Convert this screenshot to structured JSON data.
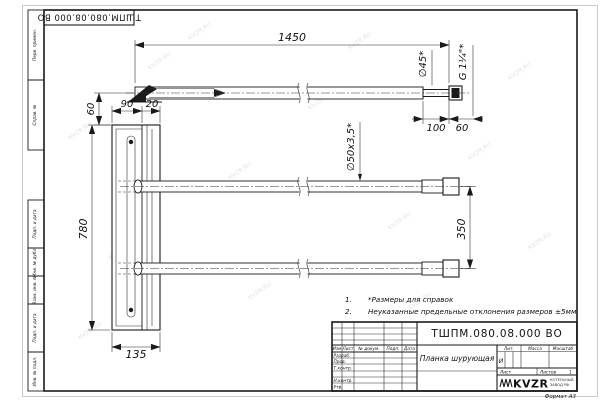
{
  "watermark": {
    "text": "KVZR.RU"
  },
  "doc_number": "ТШПМ.080.08.000 ВО",
  "side_labels": [
    "Перв. примен.",
    "Справ. №",
    "Подп. и дата",
    "Инв. № дубл.",
    "Взам. инв. №",
    "Подп. и дата",
    "Инв. № подл."
  ],
  "dims": {
    "overall_length": "1450",
    "top_offset": "60",
    "plate_width": "90",
    "plate_lip": "20",
    "plate_height": "780",
    "plate_base": "135",
    "tube_gap": "350",
    "neck_length": "100",
    "thread_length": "60"
  },
  "labels": {
    "dia_tube": "∅50x3,5*",
    "dia_end": "∅45*",
    "thread": "G 1¼\"*"
  },
  "notes": [
    {
      "num": "1.",
      "text": "*Размеры для справок"
    },
    {
      "num": "2.",
      "text": "Неуказанные предельные отклонения размеров ±5мм."
    }
  ],
  "title_block": {
    "part_name": "Планка шурующая",
    "headers": [
      "Изм",
      "Лист",
      "№ докум.",
      "Подп.",
      "Дата"
    ],
    "sign_rows": [
      "Разраб.",
      "Пров.",
      "Т.контр.",
      "Н.контр.",
      "Утв."
    ],
    "lit_label": "Лит.",
    "lit_value": "И",
    "mass_label": "Масса",
    "scale_label": "Масштаб",
    "sheet_label": "Лист",
    "sheets_label": "Листов",
    "sheets_value": "1",
    "logo_name": "KVZR",
    "logo_line1": "КОТЕЛЬНЫЙ",
    "logo_line2": "ЗАВОД РФ",
    "format_label": "Формат А3"
  }
}
